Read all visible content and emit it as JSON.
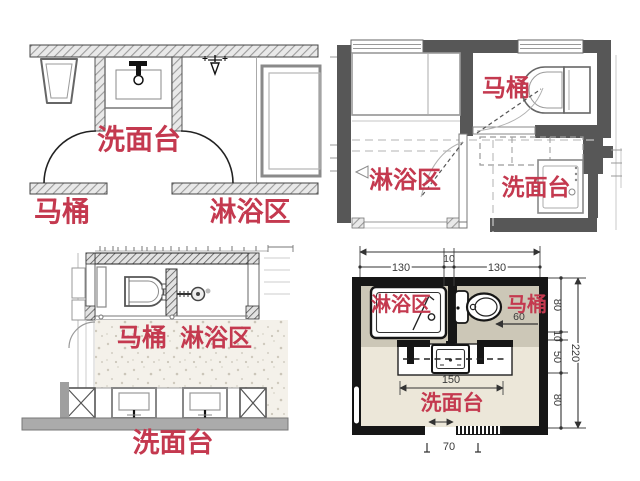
{
  "colors": {
    "accent_red": "#c4394f",
    "wall_dark_gray": "#575757",
    "wall_black": "#161616",
    "floor_cream": "#ece7d9",
    "room_gray": "#ccc7b7"
  },
  "panels": {
    "top_left": {
      "washbasin": "洗面台",
      "toilet": "马桶",
      "shower": "淋浴区"
    },
    "top_right": {
      "toilet": "马桶",
      "shower": "淋浴区",
      "washbasin": "洗面台"
    },
    "bottom_left": {
      "toilet": "马桶",
      "shower": "淋浴区",
      "washbasin": "洗面台"
    },
    "bottom_right": {
      "shower": "淋浴区",
      "toilet": "马桶",
      "washbasin": "洗面台",
      "dims": {
        "top_left_width": "130",
        "top_gap": "10",
        "top_right_width": "130",
        "toilet_clearance": "60",
        "right_seg1": "80",
        "right_seg2": "10",
        "right_seg3": "50",
        "right_seg4": "80",
        "right_total": "220",
        "vanity_width": "150",
        "door_width": "70"
      }
    }
  }
}
